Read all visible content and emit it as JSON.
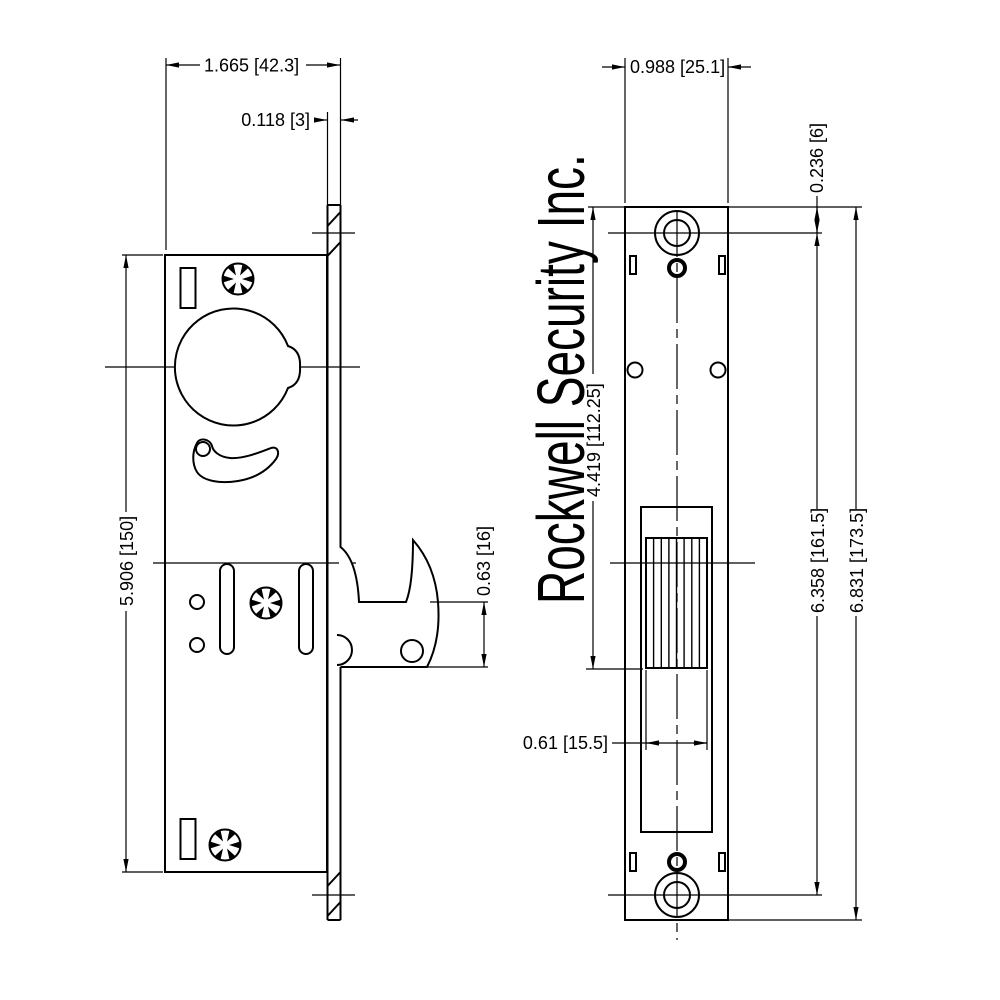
{
  "title": "Rockwell Security Inc.",
  "left_view": {
    "dims": {
      "body_width": "1.665 [42.3]",
      "faceplate_thickness": "0.118 [3]",
      "body_height": "5.906 [150]",
      "hook_depth": "0.63 [16]"
    }
  },
  "right_view": {
    "dims": {
      "faceplate_width": "0.988 [25.1]",
      "hole_edge_offset": "0.236 [6]",
      "top_to_bolt_bottom": "4.419 [112.25]",
      "hole_spacing": "6.358 [161.5]",
      "overall_height": "6.831 [173.5]",
      "bolt_slot_width": "0.61 [15.5]"
    }
  }
}
